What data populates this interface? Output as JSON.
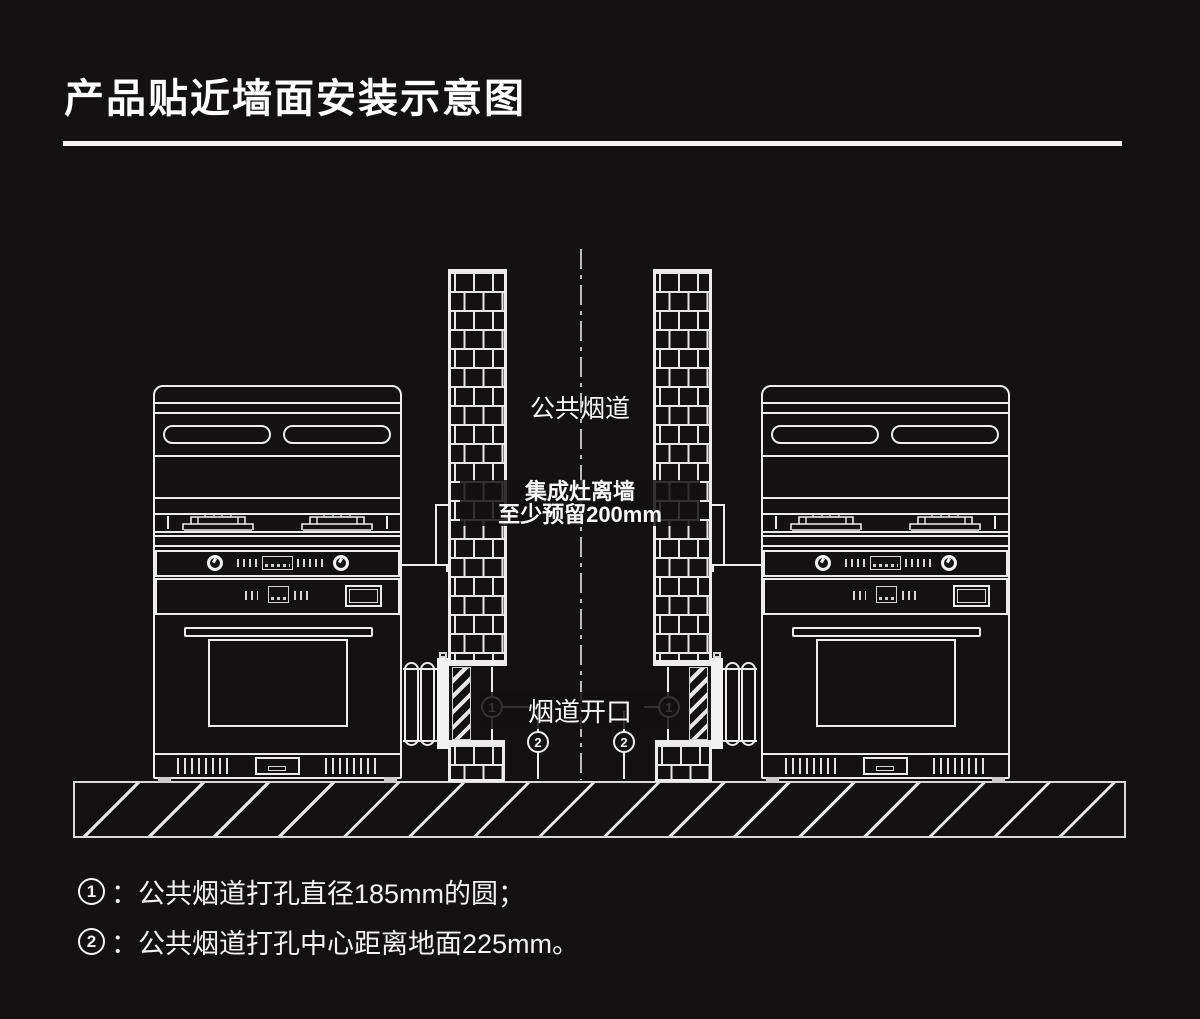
{
  "window": {
    "background": "#131111",
    "line_color": "#ececec"
  },
  "title": "产品贴近墙面安装示意图",
  "diagram": {
    "labels": {
      "public_flue": "公共烟道",
      "clearance_line1": "集成灶离墙",
      "clearance_line2": "至少预留200mm",
      "flue_opening": "烟道开口"
    },
    "markers": {
      "m1": "1",
      "m2": "2"
    }
  },
  "notes": [
    {
      "num": "1",
      "text": "：公共烟道打孔直径185mm的圆；"
    },
    {
      "num": "2",
      "text": "：公共烟道打孔中心距离地面225mm。"
    }
  ]
}
